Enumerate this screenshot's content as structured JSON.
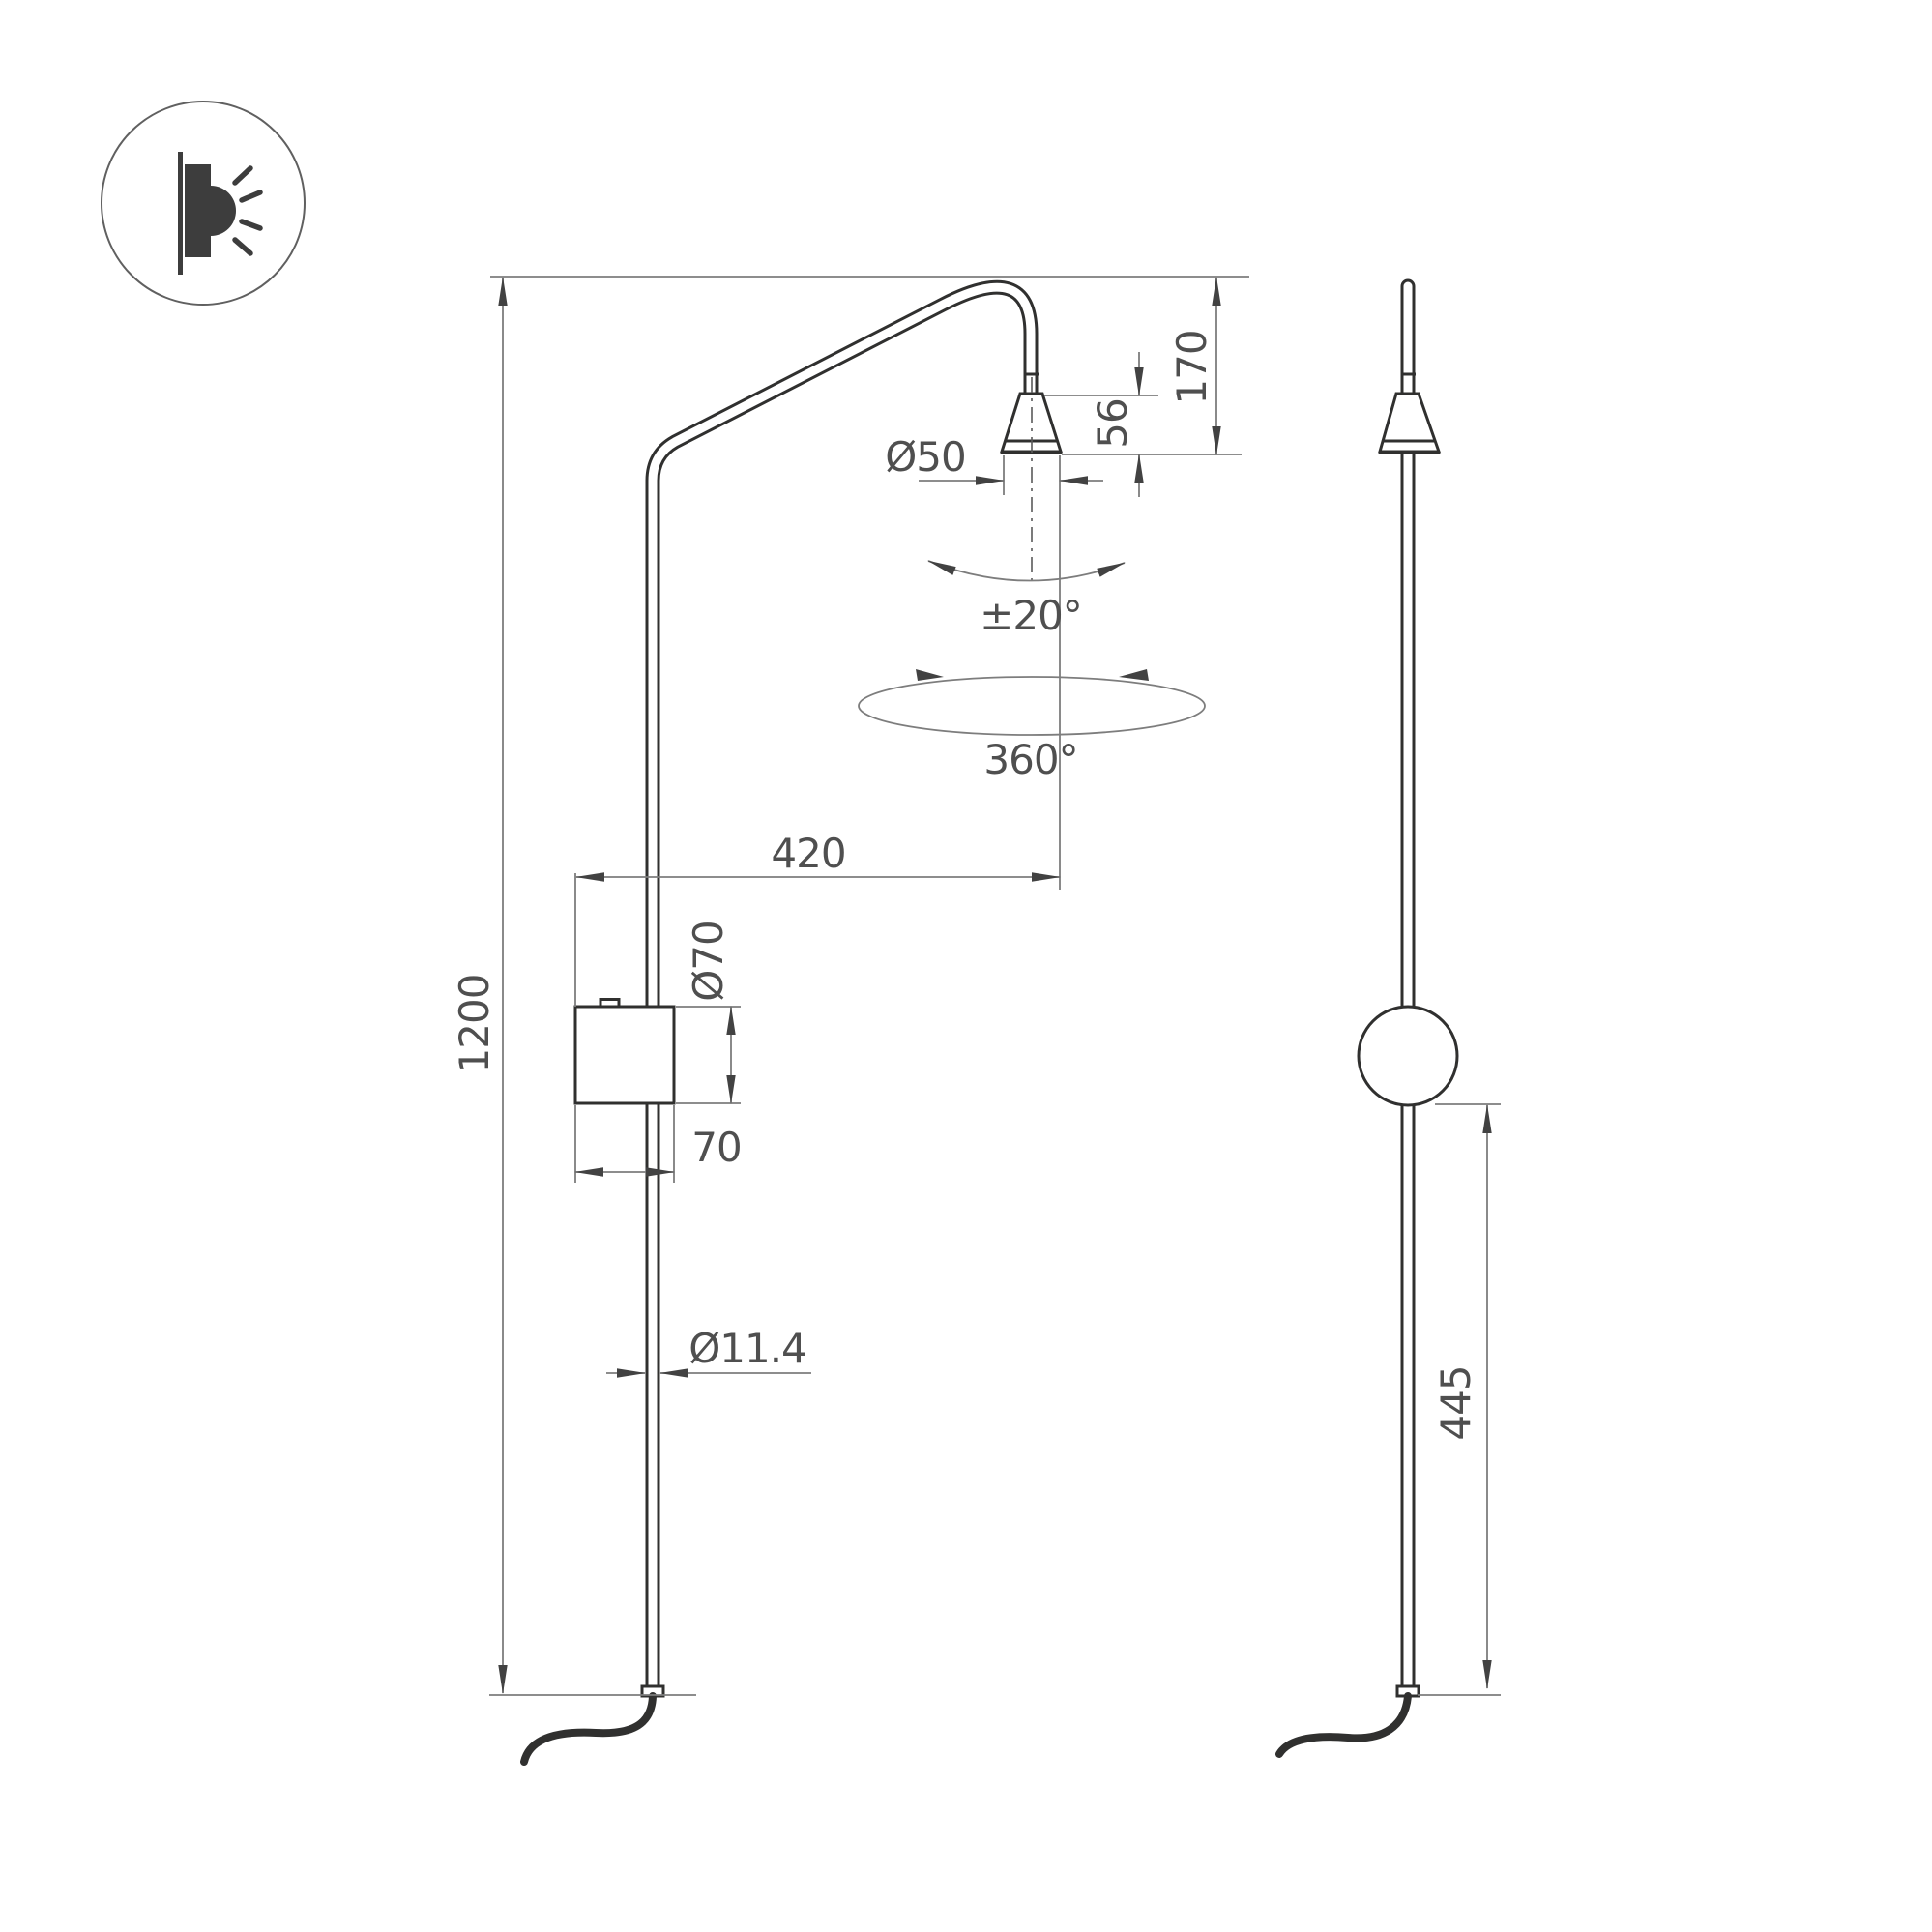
{
  "icon": {
    "name": "wall-light-icon"
  },
  "dims": {
    "overall_height": "1200",
    "arm_projection": "420",
    "head_diameter": "Ø50",
    "head_height": "56",
    "head_offset": "170",
    "tilt_range": "±20°",
    "rotation_range": "360°",
    "canopy_diameter": "Ø70",
    "canopy_width": "70",
    "tube_diameter": "Ø11.4",
    "lower_section_height": "445"
  },
  "colors": {
    "background": "#ffffff",
    "object-line": "#30302f",
    "dim-line": "#7d7d7d",
    "arrow": "#424242",
    "dim-text": "#4f4f4f",
    "icon-fill": "#3d3d3d",
    "icon-ring": "#606060",
    "centerline": "#5a5a5a"
  }
}
